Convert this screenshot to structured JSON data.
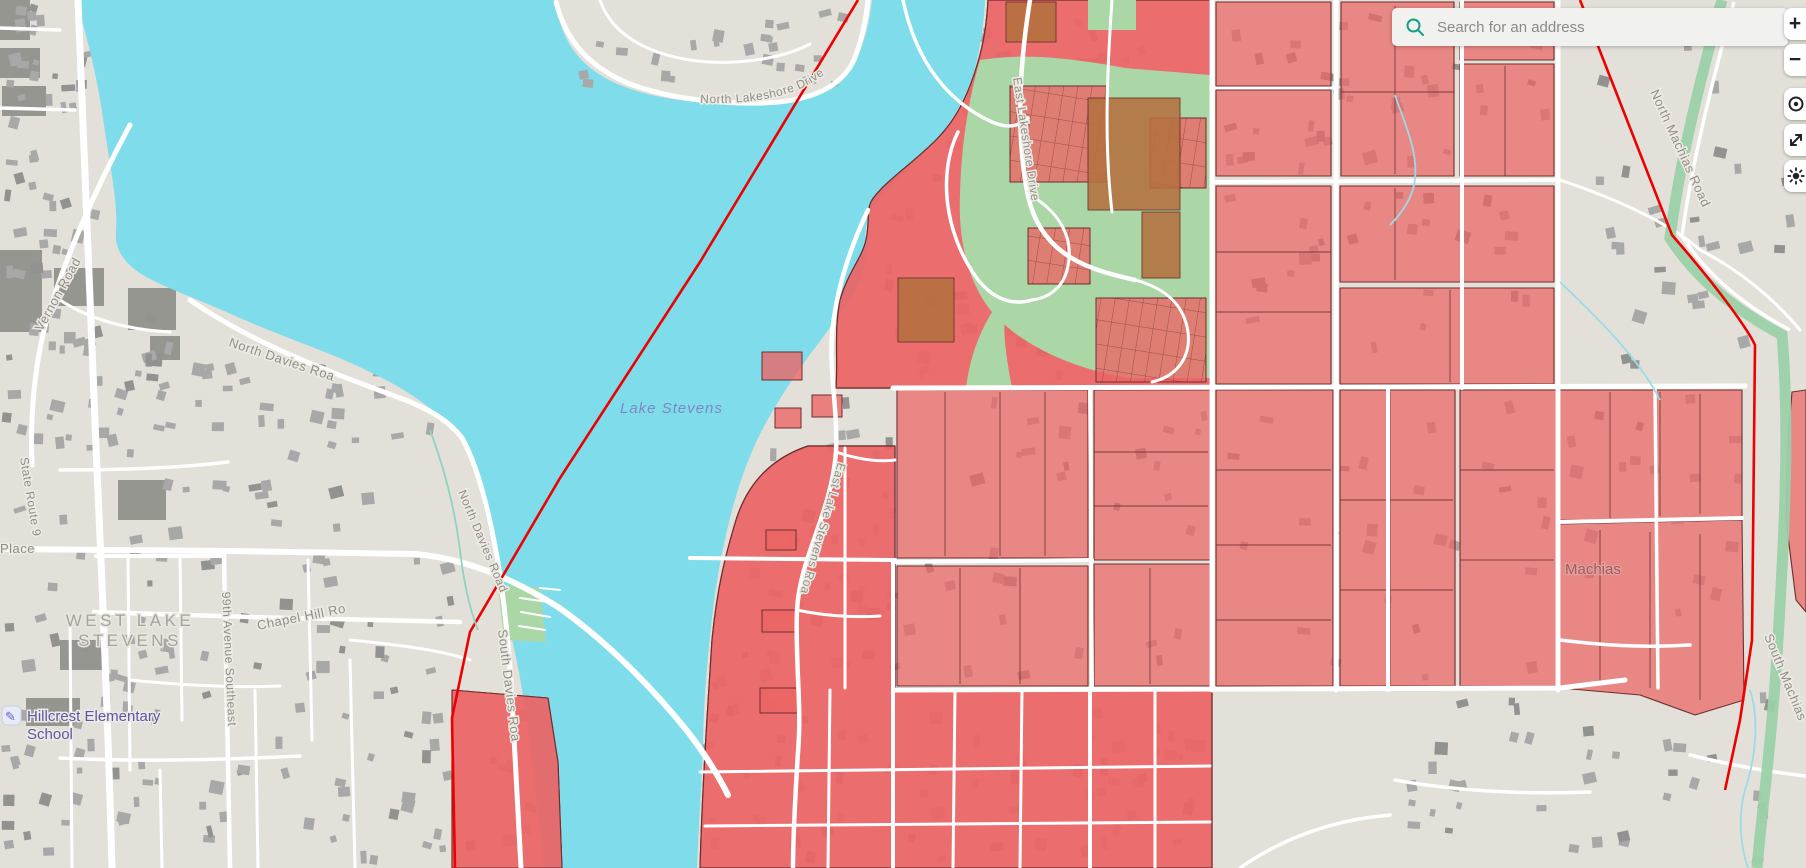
{
  "search": {
    "placeholder": "Search for an address"
  },
  "controls": {
    "zoom_in_glyph": "+",
    "zoom_out_glyph": "−",
    "locate_icon": "locate-icon",
    "fullscreen_icon": "fullscreen-icon",
    "settings_icon": "settings-icon"
  },
  "map": {
    "labels": {
      "lake": "Lake Stevens",
      "area_line1": "WEST LAKE",
      "area_line2": "STEVENS",
      "machias": "Machias",
      "school_line1": "Hillcrest Elementary",
      "school_line2": "School",
      "school_icon": "✎",
      "roads": {
        "vernon": "Vernon Road",
        "north_davies_a": "North Davies Road",
        "north_davies_b": "North Davies Road",
        "south_davies": "South Davies Road",
        "state_route_9": "State Route 9",
        "place": "Place",
        "chapel_hill": "Chapel Hill Road",
        "ave_99": "99th Avenue Southeast",
        "north_lakeshore": "North Lakeshore Drive",
        "east_lakeshore": "East Lakeshore Drive",
        "east_lake_stevens": "East Lake Stevens Road",
        "north_machias": "North Machias Road",
        "south_machias": "South Machias Road"
      }
    },
    "colors": {
      "water": "#7EDCEB",
      "land": "#E3E0D9",
      "parcel_fill": "#EB6A6A",
      "parcel_border": "#6E2E2E",
      "park": "#ABD7A6",
      "trail": "#9BD0A8",
      "boundary": "#EE0000",
      "brown_parcel": "#B5713F",
      "building": "#A8A8A8",
      "search_accent": "#12A186"
    }
  }
}
